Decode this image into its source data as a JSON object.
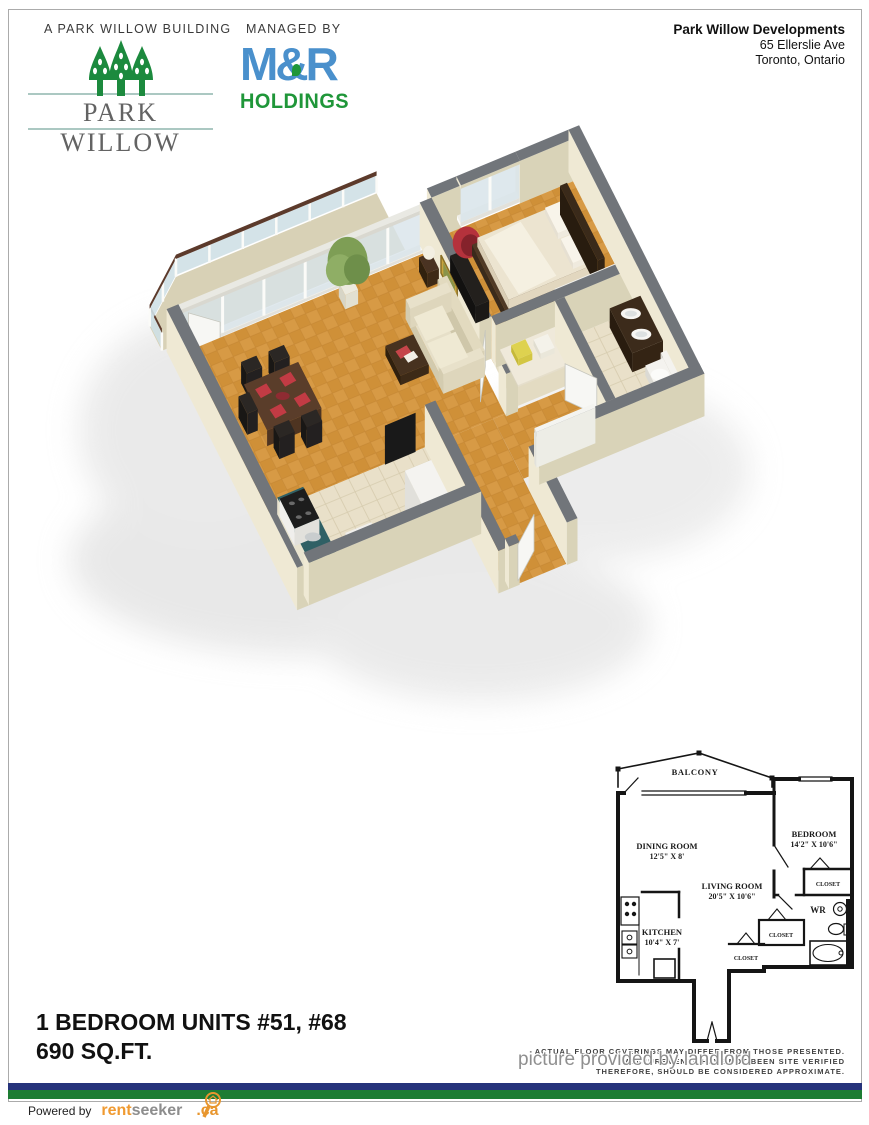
{
  "header": {
    "tagline_left": "A PARK WILLOW BUILDING",
    "tagline_center": "MANAGED BY",
    "park_willow_wordmark": "PARK WILLOW",
    "mr_logo": {
      "m": "M",
      "amp": "&",
      "r": "R",
      "holdings": "HOLDINGS"
    },
    "address": {
      "company": "Park Willow Developments",
      "street": "65 Ellerslie Ave",
      "city": "Toronto, Ontario"
    }
  },
  "unit_info": {
    "line1": "1 BEDROOM UNITS #51, #68",
    "line2": "690 SQ.FT."
  },
  "floorplan_2d": {
    "balcony": "BALCONY",
    "dining_name": "DINING ROOM",
    "dining_dims": "12'5\" X 8'",
    "living_name": "LIVING ROOM",
    "living_dims": "20'5\" X 10'6\"",
    "bedroom_name": "BEDROOM",
    "bedroom_dims": "14'2\" X 10'6\"",
    "kitchen_name": "KITCHEN",
    "kitchen_dims": "10'4\" X 7'",
    "wr": "WR",
    "closet1": "CLOSET",
    "closet2": "CLOSET",
    "closet3": "CLOSET"
  },
  "disclaimer": {
    "line1": "ACTUAL FLOOR COVERINGS MAY DIFFER FROM THOSE PRESENTED.",
    "line2": "MEASUREMENTS HAVE NOT BEEN SITE VERIFIED",
    "line3": "THEREFORE, SHOULD BE CONSIDERED APPROXIMATE."
  },
  "watermark": "picture provided by landlord",
  "footer": {
    "powered_by": "Powered by",
    "brand_rent": "rent",
    "brand_seeker": "seeker",
    "brand_tld": ".ca"
  },
  "colors": {
    "brand_green": "#1c8a3e",
    "brand_blue": "#4a90cc",
    "holdings_green": "#1f9639",
    "bar_blue": "#26337b",
    "bar_green": "#1d7c33",
    "teal_rule": "#abc8c2",
    "parquet": "#d79a45",
    "wall_cap_gray": "#71757a"
  }
}
